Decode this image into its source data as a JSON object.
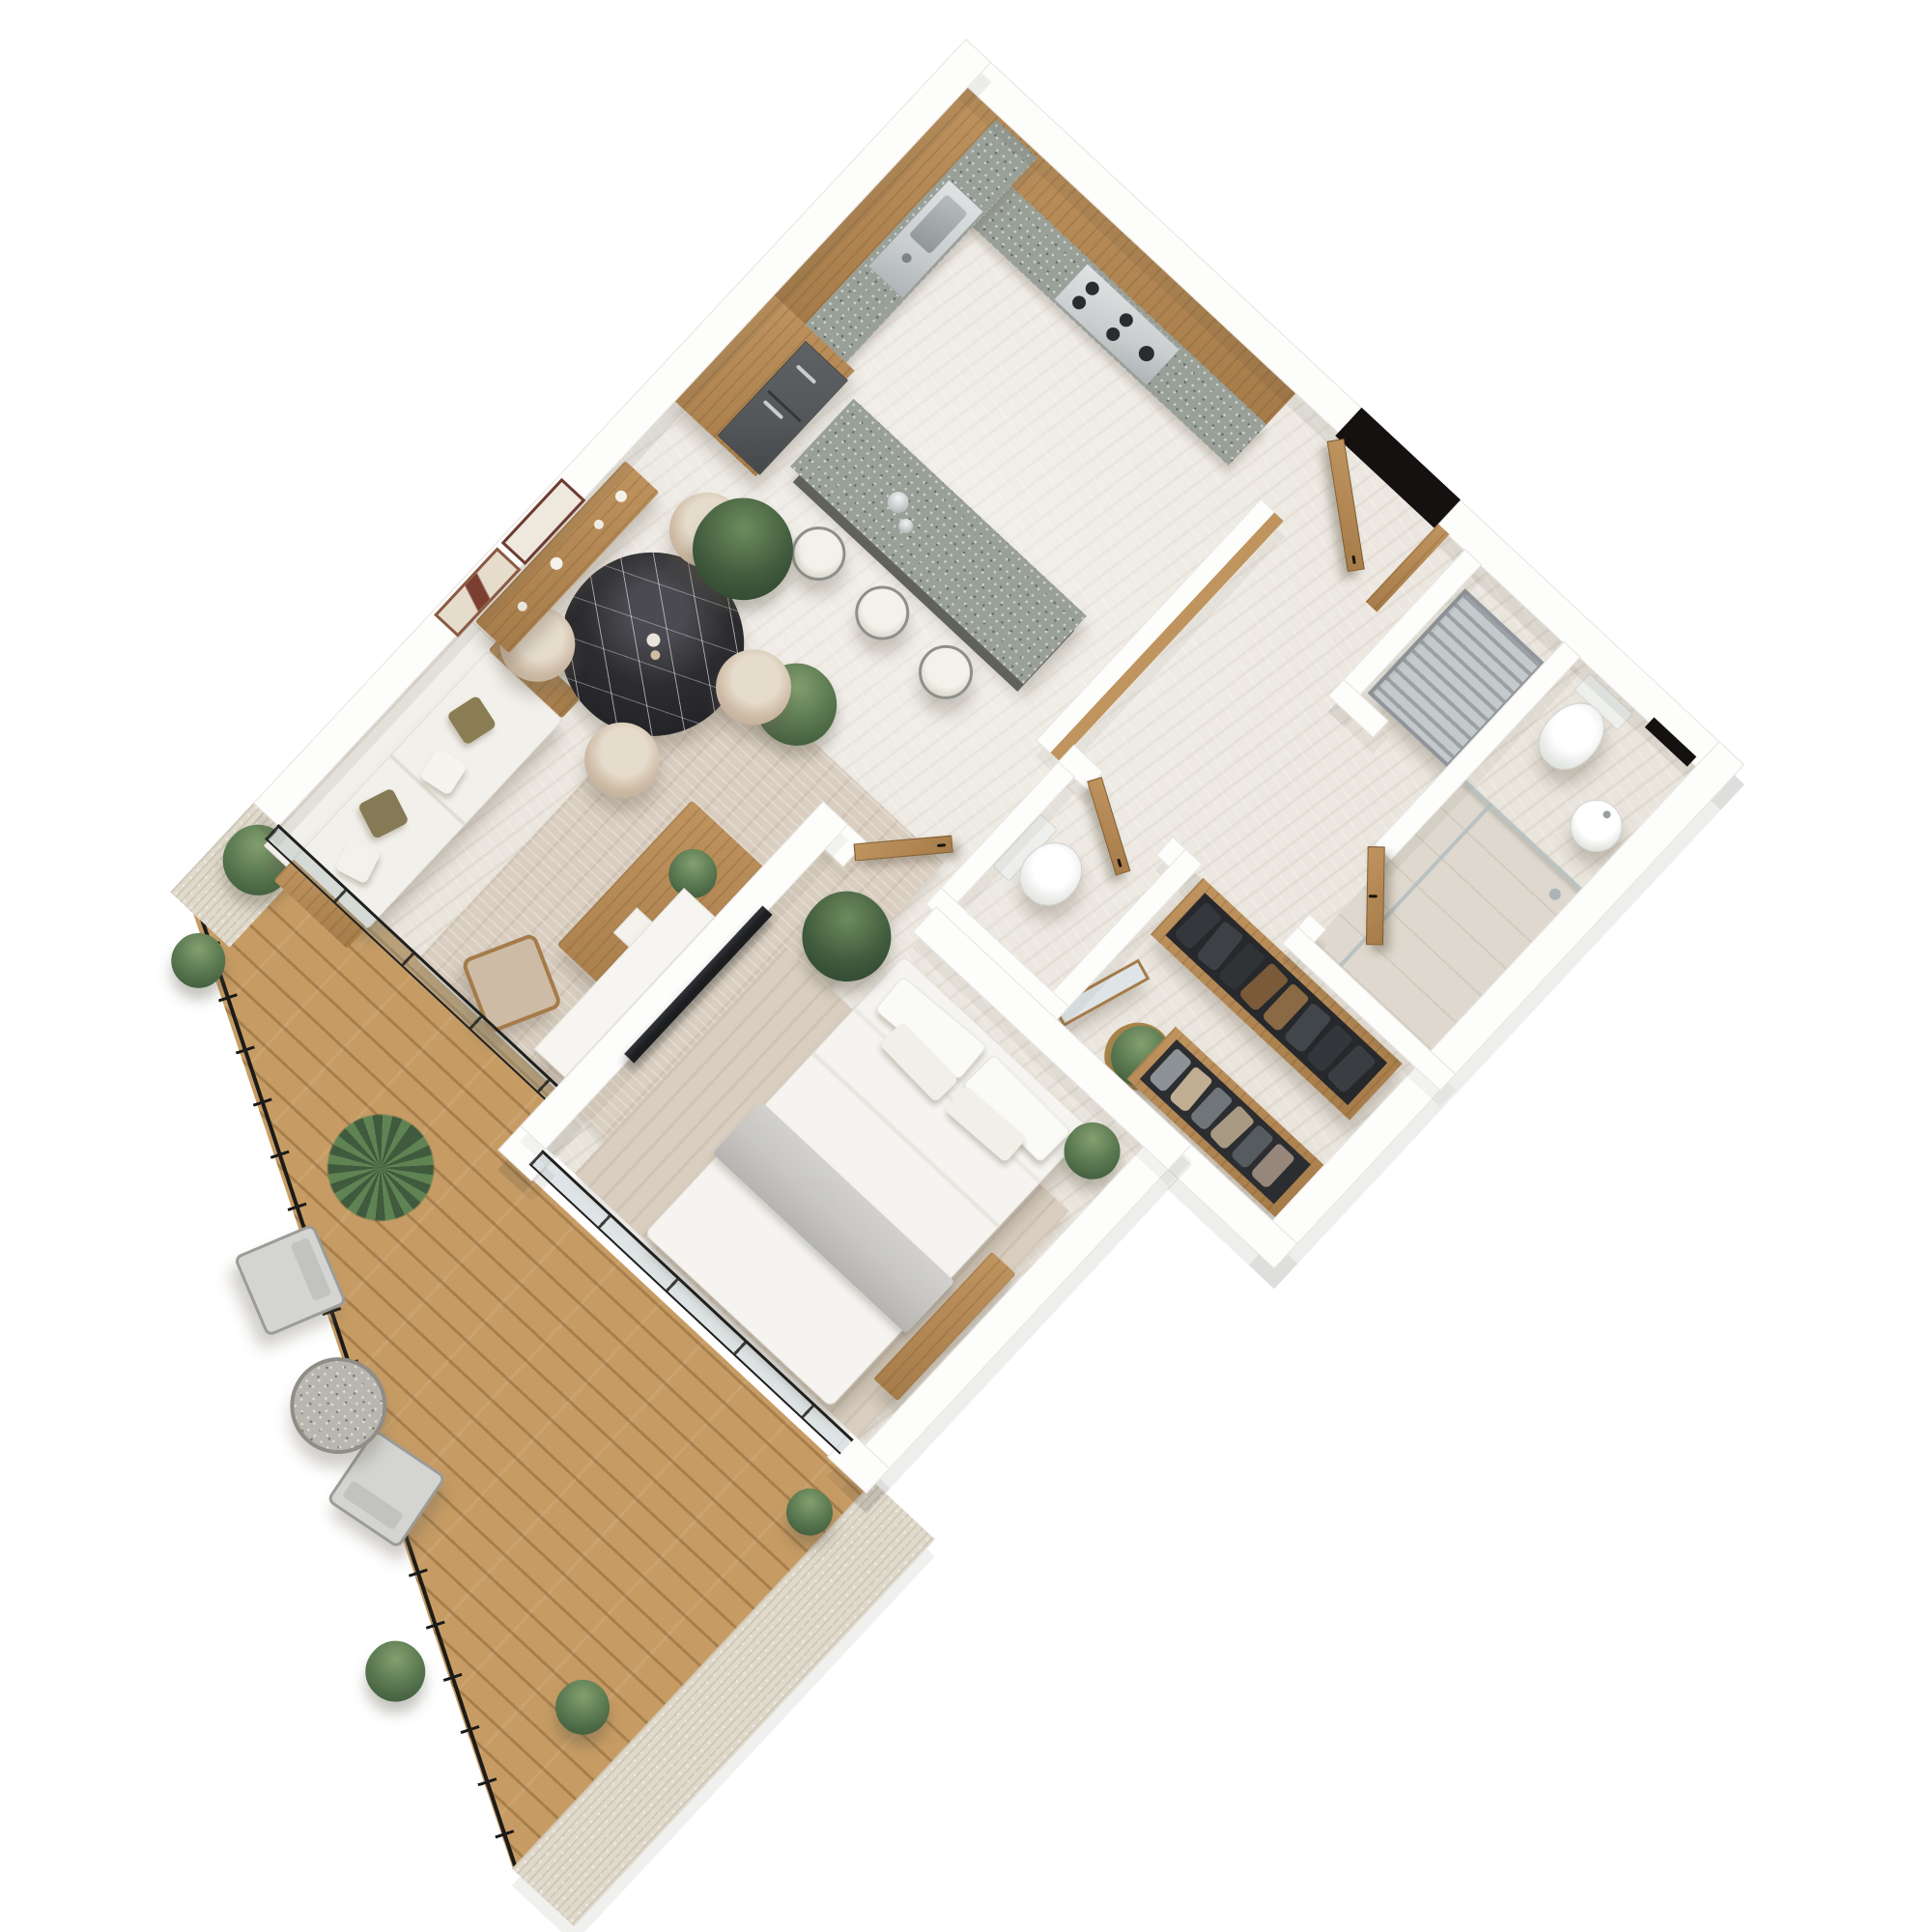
{
  "image_type": "3d_axonometric_floor_plan_render",
  "view": {
    "rotation_deg": 43,
    "projection": "axonometric top-down",
    "background": "white"
  },
  "palette": {
    "bg": "#ffffff",
    "wall": "#fdfdfc",
    "wall_edge": "#e7e4de",
    "floor": "#e9e4dc",
    "floor2": "#ded8ce",
    "wood": "#c0945f",
    "wood_dark": "#a57b49",
    "counter_stone": "#99a098",
    "island_base": "#5d635c",
    "steel": "#c9cdce",
    "fridge": "#53575a",
    "marble_dark": "#2d2d31",
    "chair_beige": "#cdbba6",
    "sofa_white": "#f2f0ea",
    "rug": "#d9cec0",
    "bed_white": "#f5f4f0",
    "throw_gray": "#c7c6c3",
    "tv_black": "#1c1d1f",
    "deck": "#c79c64",
    "railing": "#1b1b19",
    "concrete": "#e0dacd",
    "frame": "#20201e",
    "plant": "#57754e",
    "plant_dark": "#3f5a3c",
    "door_void": "#141110"
  },
  "scene": {
    "dwelling": "one-bedroom apartment",
    "rooms": [
      {
        "name": "Kitchen",
        "items": [
          "L-shaped wood cabinetry",
          "speckled stone countertop",
          "stainless sink",
          "gas cooktop",
          "graphite double-door refrigerator",
          "stone kitchen island",
          "3 bar stools",
          "silver vases"
        ]
      },
      {
        "name": "Dining area",
        "items": [
          "round black marble table",
          "4 beige tub chairs",
          "ceramic tableware"
        ]
      },
      {
        "name": "Living room",
        "items": [
          "white sofa with olive and white pillows",
          "2 framed abstract artworks",
          "wood console shelf with vases",
          "area rug",
          "wood coffee table with plant",
          "wood side chair",
          "white media sideboard",
          "wall-mounted TV",
          "potted plants"
        ]
      },
      {
        "name": "Bedroom",
        "items": [
          "double bed with white duvet",
          "4 pillows",
          "gray folded throw",
          "area rug",
          "wood bench",
          "potted plants",
          "wood pivot door"
        ]
      },
      {
        "name": "Bathroom",
        "items": [
          "toilet",
          "round pedestal basin",
          "walk-in glass shower",
          "dark wall niche"
        ]
      },
      {
        "name": "Guest WC",
        "items": [
          "toilet",
          "wood door"
        ]
      },
      {
        "name": "Dressing corridor",
        "items": [
          "open wood closet with dark hanging clothes",
          "second open closet with light clothes",
          "leaning wood-framed mirror",
          "plant in woven basket"
        ]
      },
      {
        "name": "Laundry niche",
        "items": [
          "drying rack"
        ]
      },
      {
        "name": "Entry",
        "items": [
          "open wood entry door",
          "dark door opening"
        ]
      },
      {
        "name": "Balcony",
        "items": [
          "diagonal wood deck boards",
          "black metal railing with posts",
          "concrete parapet",
          "2 light gray outdoor chairs",
          "round stone side table",
          "fern in white pot",
          "green bushes"
        ]
      }
    ]
  }
}
